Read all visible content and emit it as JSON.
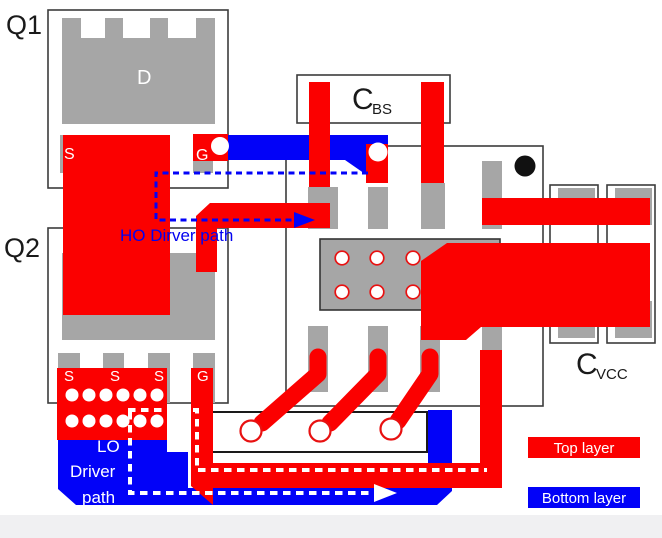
{
  "figure": {
    "type": "pcb-layout-diagram",
    "mosfets": {
      "q1_label": "Q1",
      "q2_label": "Q2",
      "drain_pad_label": "D",
      "q1_source_pad_label": "S",
      "q1_gate_pad_label": "G",
      "q2_source_pad_labels": [
        "S",
        "S",
        "S"
      ],
      "q2_gate_pad_label": "G"
    },
    "capacitors": {
      "bootstrap_symbol": "C",
      "bootstrap_subscript": "BS",
      "vcc_symbol": "C",
      "vcc_subscript": "VCC"
    },
    "annotations": {
      "ho_driver_path": "HO Dirver path",
      "lo_driver_path_line1": "LO",
      "lo_driver_path_line2": "Driver",
      "lo_driver_path_line3": "path"
    },
    "legend": {
      "top_layer_label": "Top layer",
      "bottom_layer_label": "Bottom layer",
      "top_layer_color": "#fb0000",
      "bottom_layer_color": "#0202f8"
    },
    "colors": {
      "pad_gray": "#a6a6a6",
      "outline_gray": "#3c3c3c",
      "annotation_blue": "#0202f0",
      "footer_gray": "#f0f0f2"
    }
  }
}
